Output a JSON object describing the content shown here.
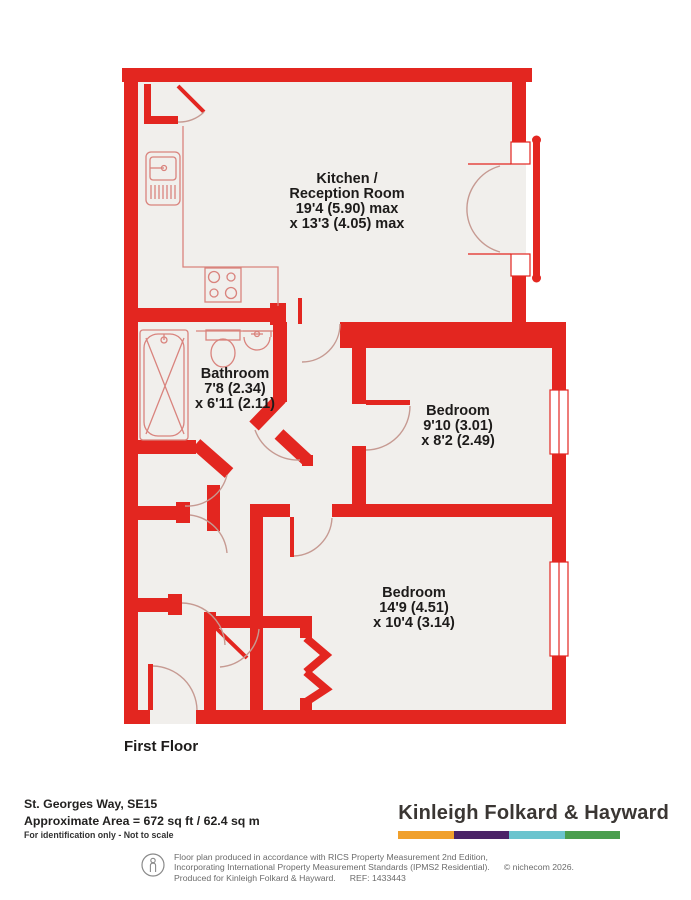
{
  "colors": {
    "wall": "#e32620",
    "floor": "#f1efec",
    "arc": "#c69a92",
    "fixture": "#d9837d",
    "text": "#1d1b1a"
  },
  "rooms": {
    "kitchen": {
      "lines": [
        "Kitchen /",
        "Reception Room",
        "19'4 (5.90) max",
        "x 13'3 (4.05) max"
      ]
    },
    "bathroom": {
      "lines": [
        "Bathroom",
        "7'8 (2.34)",
        "x 6'11 (2.11)"
      ]
    },
    "bedroom1": {
      "lines": [
        "Bedroom",
        "9'10 (3.01)",
        "x 8'2 (2.49)"
      ]
    },
    "bedroom2": {
      "lines": [
        "Bedroom",
        "14'9 (4.51)",
        "x 10'4 (3.14)"
      ]
    }
  },
  "floor_label": "First Floor",
  "footer": {
    "address": "St. Georges Way, SE15",
    "area": "Approximate Area = 672 sq ft / 62.4 sq m",
    "note": "For identification only - Not to scale",
    "brand": "Kinleigh Folkard & Hayward",
    "brand_bar_colors": [
      "#F0A02C",
      "#4A2367",
      "#6BC4CE",
      "#4A9E4E"
    ],
    "disclaimer_line1": "Floor plan produced in accordance with RICS Property Measurement 2nd Edition,",
    "disclaimer_line2": "Incorporating International Property Measurement Standards (IPMS2 Residential).",
    "copyright": "© nichecom 2026.",
    "disclaimer_line3": "Produced for Kinleigh Folkard & Hayward.",
    "ref": "REF: 1433443"
  }
}
